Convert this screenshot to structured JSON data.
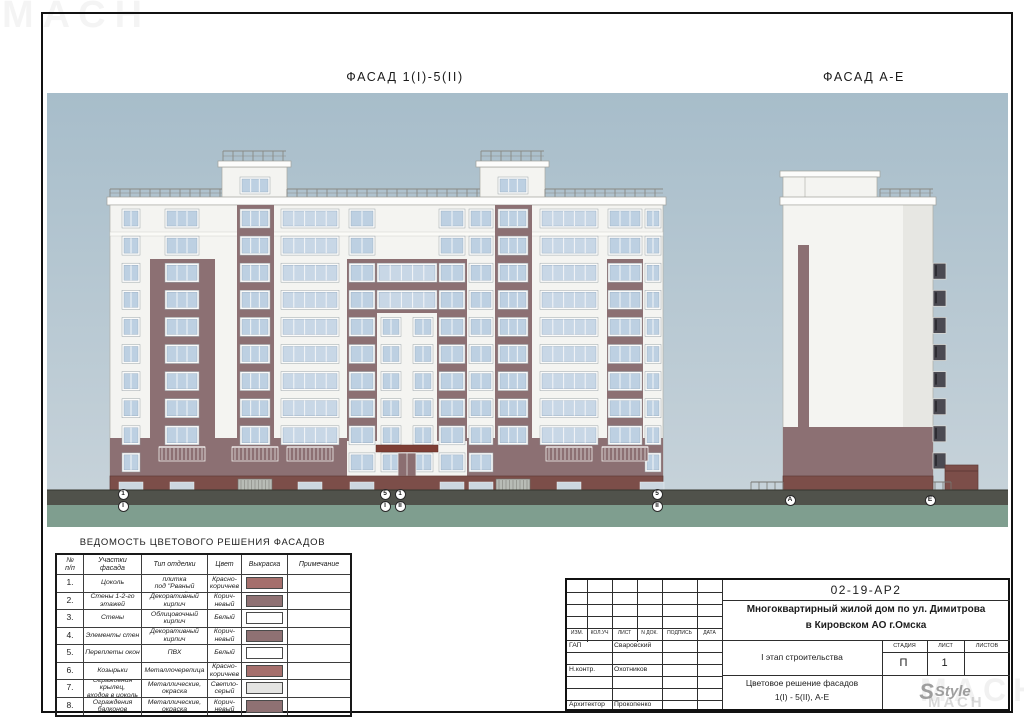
{
  "watermark": {
    "text": "МАСН"
  },
  "titles": {
    "facade1": "ФАСАД 1(I)-5(II)",
    "facade2": "ФАСАД А-Е"
  },
  "axes": {
    "facade1": [
      {
        "top": "1",
        "bottom": "I"
      },
      {
        "top": "5",
        "bottom": "I"
      },
      {
        "top": "1",
        "bottom": "II"
      },
      {
        "top": "5",
        "bottom": "II"
      }
    ],
    "facade2": [
      "А",
      "Е"
    ]
  },
  "legend": {
    "title": "ВЕДОМОСТЬ ЦВЕТОВОГО РЕШЕНИЯ ФАСАДОВ",
    "columns": [
      "№\nп/п",
      "Участки фасада",
      "Тип отделки",
      "Цвет",
      "Выкраска",
      "Примечание"
    ],
    "rows": [
      {
        "num": "1.",
        "area": "Цоколь",
        "finish": "Керамогранитная плитка\nпод \"Рваный камень\"",
        "color": "Красно-\nкоричнев",
        "swatch": "#a56f6c",
        "note": ""
      },
      {
        "num": "2.",
        "area": "Стены 1-2-го этажей",
        "finish": "Декоративный\nкирпич",
        "color": "Корич-\nневый",
        "swatch": "#8f7173",
        "note": ""
      },
      {
        "num": "3.",
        "area": "Стены",
        "finish": "Облицовочный\nкирпич",
        "color": "Белый",
        "swatch": "#ffffff",
        "note": ""
      },
      {
        "num": "4.",
        "area": "Элементы стен",
        "finish": "Декоративный\nкирпич",
        "color": "Корич-\nневый",
        "swatch": "#8f7173",
        "note": ""
      },
      {
        "num": "5.",
        "area": "Переплеты окон",
        "finish": "ПВХ",
        "color": "Белый",
        "swatch": "#ffffff",
        "note": ""
      },
      {
        "num": "6.",
        "area": "Козырьки",
        "finish": "Металлочерепица",
        "color": "Красно-\nкоричнев",
        "swatch": "#a56f6c",
        "note": ""
      },
      {
        "num": "7.",
        "area": "Ограждения крылец,\nвходов в цоколь",
        "finish": "Металлические, окраска",
        "color": "Светло-\nсерый",
        "swatch": "#e4e4e2",
        "note": ""
      },
      {
        "num": "8.",
        "area": "Ограждения\nбалконов",
        "finish": "Металлические, окраска",
        "color": "Корич-\nневый",
        "swatch": "#8f7173",
        "note": ""
      }
    ]
  },
  "stamp": {
    "doc_number": "02-19-АР2",
    "project_line1": "Многоквартирный жилой дом по ул. Димитрова",
    "project_line2": "в Кировском АО г.Омска",
    "header_cells": [
      "ИЗМ.",
      "КОЛ.УЧ",
      "ЛИСТ",
      "N ДОК.",
      "ПОДПИСЬ",
      "ДАТА"
    ],
    "role_rows": [
      {
        "role": "ГАП",
        "name": "Сваровский"
      },
      {
        "role": "",
        "name": ""
      },
      {
        "role": "Н.контр.",
        "name": "Охотников"
      },
      {
        "role": "",
        "name": ""
      },
      {
        "role": "",
        "name": ""
      },
      {
        "role": "Архитектор",
        "name": "Прокопенко"
      }
    ],
    "stage_text": "I этап строительства",
    "sheet_title_line1": "Цветовое решение фасадов",
    "sheet_title_line2": "1(I) - 5(II), А-Е",
    "stage_label": "СТАДИЯ",
    "sheet_label": "ЛИСТ",
    "sheets_label": "ЛИСТОВ",
    "stage_value": "П",
    "sheet_value": "1",
    "sheets_value": "",
    "logo": "Style"
  },
  "colors": {
    "sky_top": "#a7bdca",
    "sky_bottom": "#c9d4db",
    "wall_white": "#f4f4f1",
    "facade_brown": "#8c7073",
    "plinth_maroon": "#7c4e49",
    "window_blue": "#bdd0e2",
    "balcony_blue": "#c8d7e6",
    "canopy_red_brown": "#7e3e35",
    "dark_window": "#4b4a52",
    "ground_dark": "#50524b",
    "grass_green": "#7f9e8f",
    "railing_gray": "#8a8a85"
  }
}
